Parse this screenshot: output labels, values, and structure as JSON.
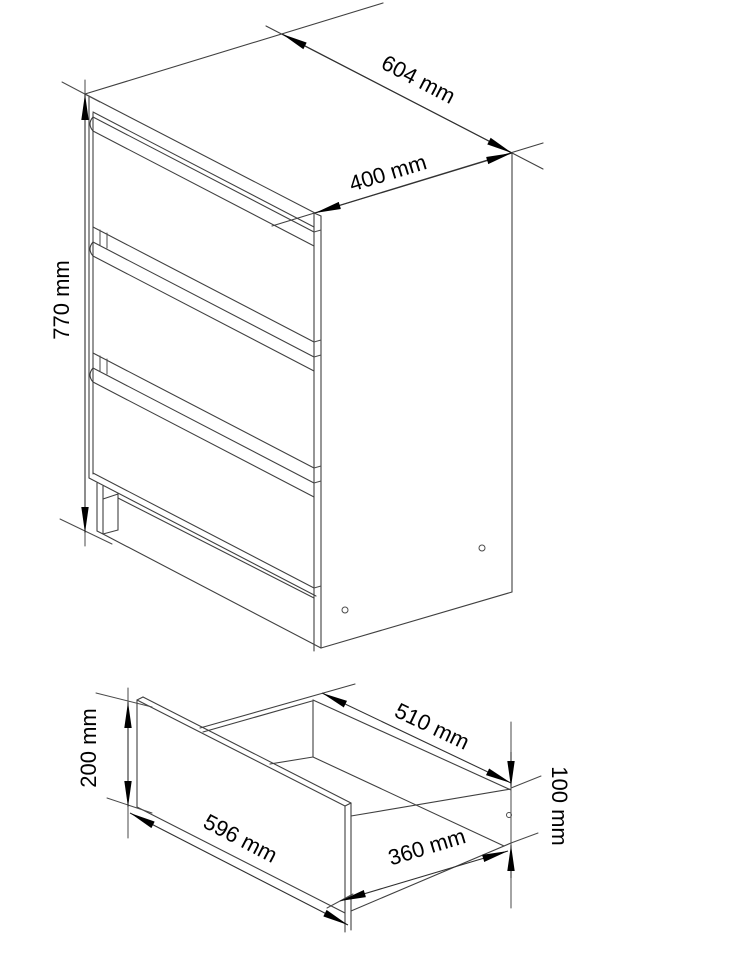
{
  "page": {
    "background": "#ffffff",
    "description": "Technical dimension drawing of a three-drawer chest and a single drawer box"
  },
  "drawing": {
    "line_color": "#404040",
    "arrow_color": "#000000",
    "text_color": "#000000",
    "figures": {
      "cabinet": {
        "name": "three-drawer-chest",
        "drawer_count": 3,
        "dimensions": {
          "width": "604 mm",
          "depth": "400 mm",
          "height": "770 mm"
        }
      },
      "drawer": {
        "name": "drawer-box",
        "dimensions": {
          "front_height": "200 mm",
          "front_width": "596 mm",
          "side_depth": "510 mm",
          "side_height": "100 mm",
          "inner_depth": "360 mm"
        }
      }
    }
  }
}
